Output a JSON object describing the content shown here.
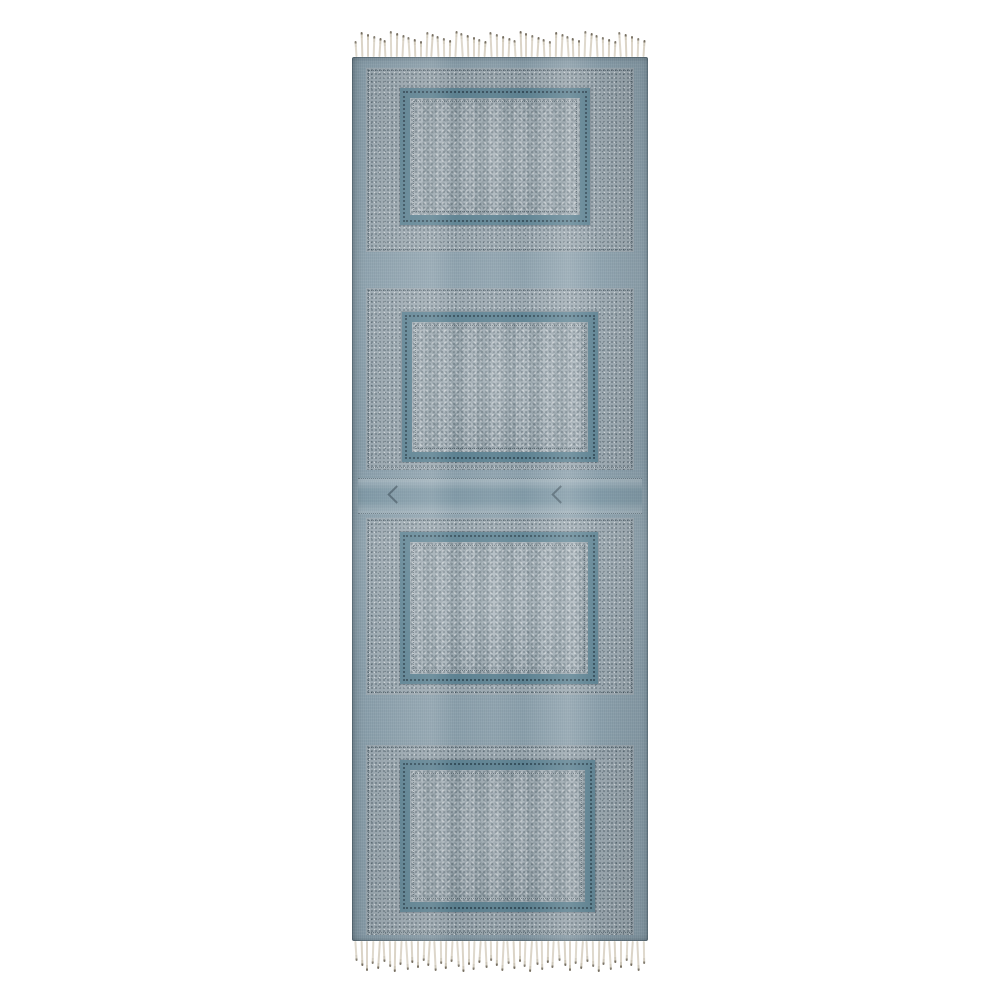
{
  "scene": {
    "type": "product-photo",
    "subject": "Hand block-printed blue cotton runner rug with four framed panels and fringed ends",
    "background_color": "#ffffff"
  },
  "rug": {
    "colors": {
      "base": "#8ca1ad",
      "print_ground": "#9aa7af",
      "field": "#a3afb6",
      "frame_teal": "#5d8292",
      "stitch_dark": "#24383f",
      "fringe": "#d9d2c4",
      "fringe_knot": "#6f6758"
    },
    "layout": {
      "left": 352,
      "top": 30,
      "width": 296,
      "fringe_top_height": 27,
      "body_height": 884,
      "fringe_bottom_height": 34
    },
    "panel_count": 4,
    "panels": [
      {
        "block": {
          "top": 11,
          "height": 184
        },
        "frame": {
          "top": 20,
          "left": 34,
          "width": 190,
          "height": 137
        }
      },
      {
        "block": {
          "top": 231,
          "height": 182
        },
        "frame": {
          "top": 24,
          "left": 36,
          "width": 196,
          "height": 150
        }
      },
      {
        "block": {
          "top": 461,
          "height": 177
        },
        "frame": {
          "top": 14,
          "left": 34,
          "width": 198,
          "height": 152
        }
      },
      {
        "block": {
          "top": 688,
          "height": 190
        },
        "frame": {
          "top": 15,
          "left": 34,
          "width": 195,
          "height": 152
        }
      }
    ],
    "divider": {
      "top": 421,
      "height": 34
    },
    "fringe": {
      "top": {
        "count": 50,
        "min_len": 16,
        "max_len": 26
      },
      "bottom": {
        "count": 52,
        "min_len": 20,
        "max_len": 31
      }
    }
  }
}
